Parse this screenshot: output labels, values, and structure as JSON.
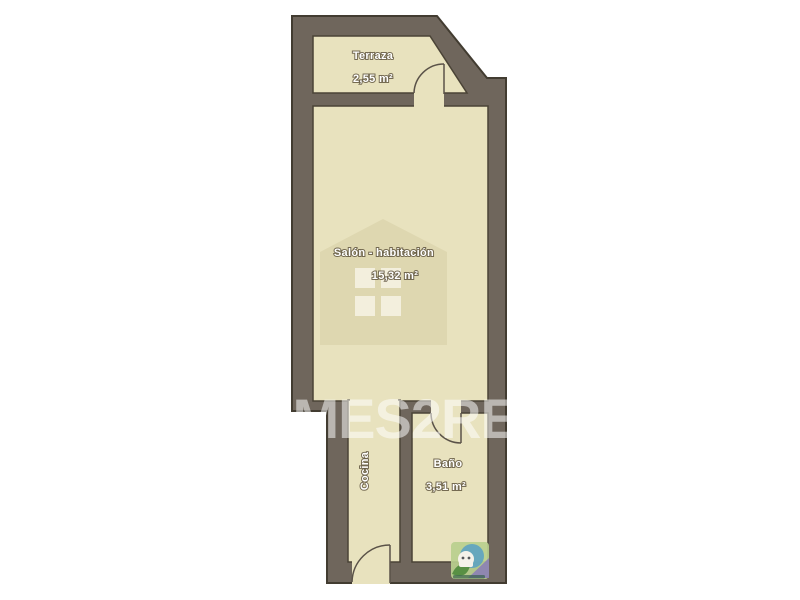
{
  "floorplan": {
    "title": "apartment floor plan",
    "rooms": {
      "terraza": {
        "label": "Terraza",
        "area": "2,55 m²"
      },
      "salon": {
        "label": "Salón - habitación",
        "area": "15,32 m²"
      },
      "cocina": {
        "label": "Cocina",
        "area": ""
      },
      "bano": {
        "label": "Baño",
        "area": "3,51 m²"
      }
    },
    "watermark": {
      "text": "HOMES2RENT"
    },
    "colors": {
      "background": "#ffffff",
      "wall_fill": "#6f665c",
      "wall_outline": "#423c31",
      "room_fill": "#e8e2be",
      "watermark_house": "#ded7b0",
      "watermark_window": "#f7f4e6",
      "label_text": "#ffffff"
    },
    "logo_colors": {
      "square": "#b9cf8e",
      "circle": "#58a0c4",
      "triangle": "#8b7fb5",
      "leaf": "#4e8a3c",
      "house": "#f5f2ea"
    }
  }
}
